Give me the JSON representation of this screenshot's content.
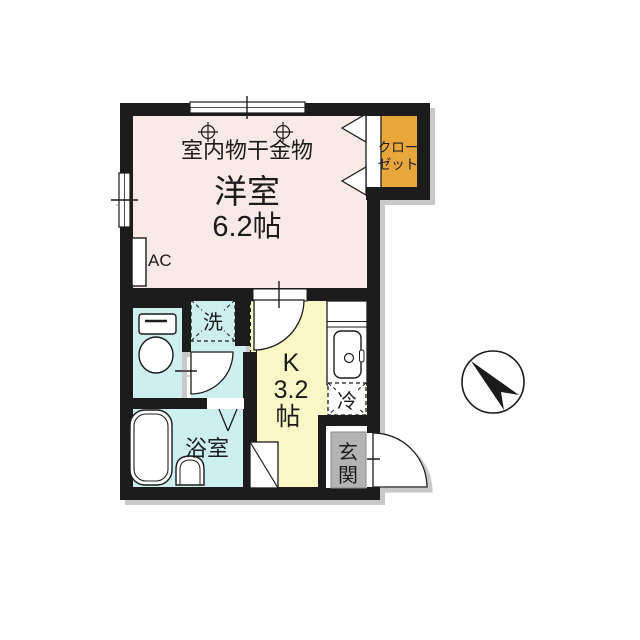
{
  "plan": {
    "main_room": {
      "note": "室内物干金物",
      "name": "洋室",
      "size": "6.2帖",
      "ac_label": "AC"
    },
    "closet": {
      "label_line1": "クロー",
      "label_line2": "ゼット"
    },
    "washroom": {
      "washer_label": "洗"
    },
    "kitchen": {
      "label": "K",
      "size": "3.2",
      "size_unit": "帖",
      "fridge_label": "冷"
    },
    "bathroom": {
      "label": "浴室"
    },
    "entrance": {
      "label_char1": "玄",
      "label_char2": "関"
    },
    "compass": {
      "direction": "northwest"
    }
  },
  "colors": {
    "wall": "#1b1b1b",
    "main_room_pink": "#f9e9e7",
    "wet_area_cyan": "#cdf0ef",
    "kitchen_yellow": "#f9f8c6",
    "closet_orange": "#e9a73b",
    "entrance_gray": "#b3b3b3",
    "shadow_gray": "#c9c9c9"
  }
}
